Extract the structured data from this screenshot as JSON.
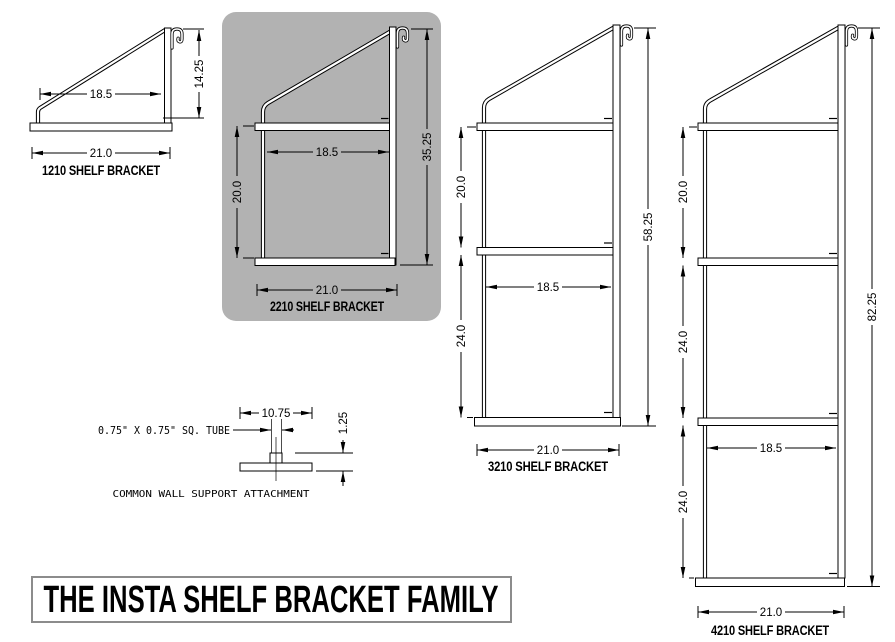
{
  "banner": {
    "title": "THE INSTA SHELF BRACKET FAMILY"
  },
  "brackets": [
    {
      "model": "1210",
      "label": "1210 SHELF BRACKET",
      "highlighted": false,
      "dims": {
        "depth": "18.5",
        "height": "14.25",
        "width": "21.0"
      }
    },
    {
      "model": "2210",
      "label": "2210 SHELF BRACKET",
      "highlighted": true,
      "dims": {
        "depth": "18.5",
        "shelf_spacing": "20.0",
        "height": "35.25",
        "width": "21.0"
      }
    },
    {
      "model": "3210",
      "label": "3210 SHELF BRACKET",
      "highlighted": false,
      "dims": {
        "shelf_spacing_top": "20.0",
        "shelf_spacing_bottom": "24.0",
        "depth": "18.5",
        "height": "58.25",
        "width": "21.0"
      }
    },
    {
      "model": "4210",
      "label": "4210 SHELF BRACKET",
      "highlighted": false,
      "dims": {
        "shelf_spacing_top": "20.0",
        "shelf_spacing_middle": "24.0",
        "shelf_spacing_bottom": "24.0",
        "depth": "18.5",
        "height": "82.25",
        "width": "21.0"
      }
    }
  ],
  "attachment": {
    "tube_note": "0.75\" X 0.75\" SQ. TUBE",
    "plate_width": "10.75",
    "offset_height": "1.25",
    "caption": "COMMON WALL SUPPORT ATTACHMENT"
  },
  "colors": {
    "highlight": "#b2b2b2",
    "line": "#000000",
    "background": "#ffffff"
  }
}
